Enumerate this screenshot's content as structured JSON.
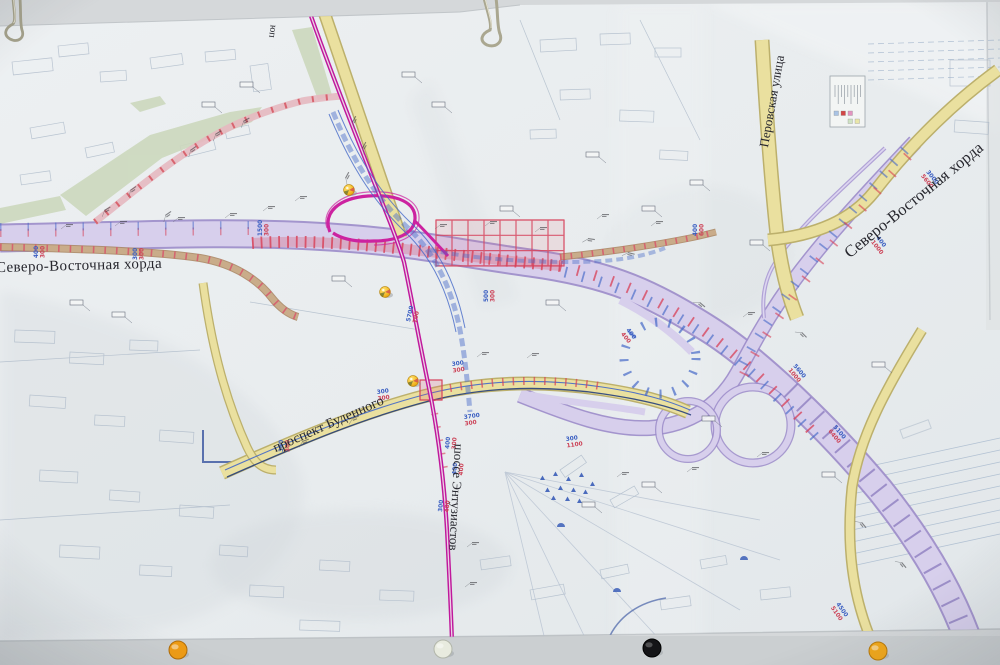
{
  "photo": {
    "labels": {
      "chord_left": "Северо-Восточная хорда",
      "chord_right": "Северо-Восточная хорда",
      "perovskaya_street": "Перовская улица",
      "budennogo_prospect": "проспект Буденного",
      "entuziastov_highway": "шоссе Энтузиастов",
      "edge_fragment": "юп"
    },
    "colors": {
      "wall": "#d5d8da",
      "board_bottom": "#cbcfd1",
      "paper": "#eaeef0",
      "corridor_fill": "#d7cfec",
      "corridor_edge": "#9b8bc9",
      "road_yellow": "#eae09f",
      "road_yellow_edge": "#bcb06c",
      "magenta": "#c0189c",
      "construction_red": "#d83f55",
      "plan_blue": "#4468c8",
      "tan_road": "#c9ac8a",
      "tan_edge": "#a8845e",
      "park_green": "#ccd8bd",
      "faint_city": "#a8b6c6",
      "dim_blue": "#3a5ec2",
      "dim_red": "#cc4257"
    },
    "legend_swatches": [
      "#a9c3e4",
      "#d24646",
      "#e394c0",
      "#cfe2c4",
      "#e9e6a8"
    ],
    "measurements": [
      {
        "x": 38,
        "y": 258,
        "rot": -90,
        "blue": "400",
        "red": "300"
      },
      {
        "x": 137,
        "y": 260,
        "rot": -90,
        "blue": "300",
        "red": "300"
      },
      {
        "x": 262,
        "y": 236,
        "rot": -90,
        "blue": "1500",
        "red": "300"
      },
      {
        "x": 410,
        "y": 322,
        "rot": -78,
        "blue": "5700",
        "red": "700"
      },
      {
        "x": 452,
        "y": 366,
        "rot": -8,
        "blue": "300",
        "red": "300"
      },
      {
        "x": 464,
        "y": 419,
        "rot": -8,
        "blue": "3700",
        "red": "300"
      },
      {
        "x": 377,
        "y": 394,
        "rot": -8,
        "blue": "300",
        "red": "300"
      },
      {
        "x": 283,
        "y": 452,
        "rot": -90,
        "blue": "300",
        "red": "300"
      },
      {
        "x": 449,
        "y": 449,
        "rot": -85,
        "blue": "400",
        "red": "300"
      },
      {
        "x": 456,
        "y": 475,
        "rot": -85,
        "blue": "400",
        "red": "400"
      },
      {
        "x": 442,
        "y": 512,
        "rot": -85,
        "blue": "300",
        "red": "400"
      },
      {
        "x": 626,
        "y": 330,
        "rot": 52,
        "blue": "400",
        "red": "400"
      },
      {
        "x": 793,
        "y": 366,
        "rot": 50,
        "blue": "5600",
        "red": "1000"
      },
      {
        "x": 876,
        "y": 238,
        "rot": 52,
        "blue": "400",
        "red": "1000"
      },
      {
        "x": 926,
        "y": 172,
        "rot": 52,
        "blue": "3000",
        "red": "5600"
      },
      {
        "x": 697,
        "y": 236,
        "rot": -90,
        "blue": "400",
        "red": "600"
      },
      {
        "x": 833,
        "y": 427,
        "rot": 50,
        "blue": "5100",
        "red": "6400"
      },
      {
        "x": 836,
        "y": 604,
        "rot": 55,
        "blue": "4500",
        "red": "5100"
      },
      {
        "x": 566,
        "y": 441,
        "rot": -8,
        "blue": "300",
        "red": "1100"
      },
      {
        "x": 488,
        "y": 302,
        "rot": -90,
        "blue": "500",
        "red": "300"
      }
    ],
    "map_tacks": [
      {
        "x": 349,
        "y": 190
      },
      {
        "x": 385,
        "y": 292
      },
      {
        "x": 413,
        "y": 381
      }
    ],
    "board_pins": [
      {
        "x": 178,
        "y": 650,
        "color": "#ef9c14",
        "edge": "#b06c08",
        "name": "orange-pin"
      },
      {
        "x": 443,
        "y": 649,
        "color": "#e8ebdf",
        "edge": "#b2b6aa",
        "name": "white-pin"
      },
      {
        "x": 652,
        "y": 648,
        "color": "#141417",
        "edge": "#000000",
        "name": "black-pin"
      },
      {
        "x": 878,
        "y": 651,
        "color": "#f2a81a",
        "edge": "#b8790a",
        "name": "yellow-pin"
      }
    ]
  }
}
